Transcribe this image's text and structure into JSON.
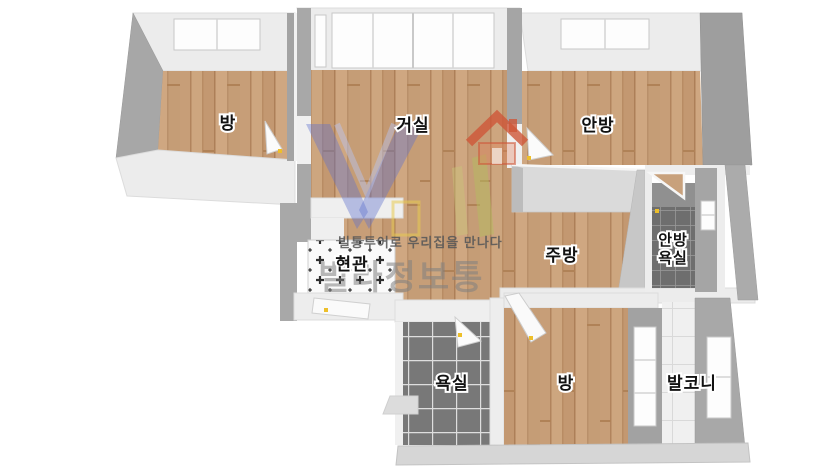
{
  "watermark": {
    "slogan": "빌통투어로 우리집을 만나다",
    "brand": "빌라정보통"
  },
  "rooms": [
    {
      "id": "bedroom-top-left",
      "label": "방"
    },
    {
      "id": "living-room",
      "label": "거실"
    },
    {
      "id": "master-bedroom",
      "label": "안방"
    },
    {
      "id": "entrance",
      "label": "현관"
    },
    {
      "id": "kitchen",
      "label": "주방"
    },
    {
      "id": "master-bathroom",
      "label_line1": "안방",
      "label_line2": "욕실"
    },
    {
      "id": "bathroom",
      "label": "욕실"
    },
    {
      "id": "bedroom-bottom",
      "label": "방"
    },
    {
      "id": "balcony",
      "label": "발코니"
    }
  ],
  "colors": {
    "floor_wood": "#c9a17c",
    "wall_gray": "#a6a6a6",
    "wall_light": "#ececec",
    "tile_dark": "#787878",
    "tile_small_dark": "#6e6e6e",
    "tile_light": "#f0f0f0",
    "entrance_tile_mark": "#303030",
    "hinge_yellow": "#edbf2a",
    "logo_blue": "#5f71cd",
    "logo_roof": "#ce5638",
    "logo_leaf": "#b6bc5f"
  }
}
